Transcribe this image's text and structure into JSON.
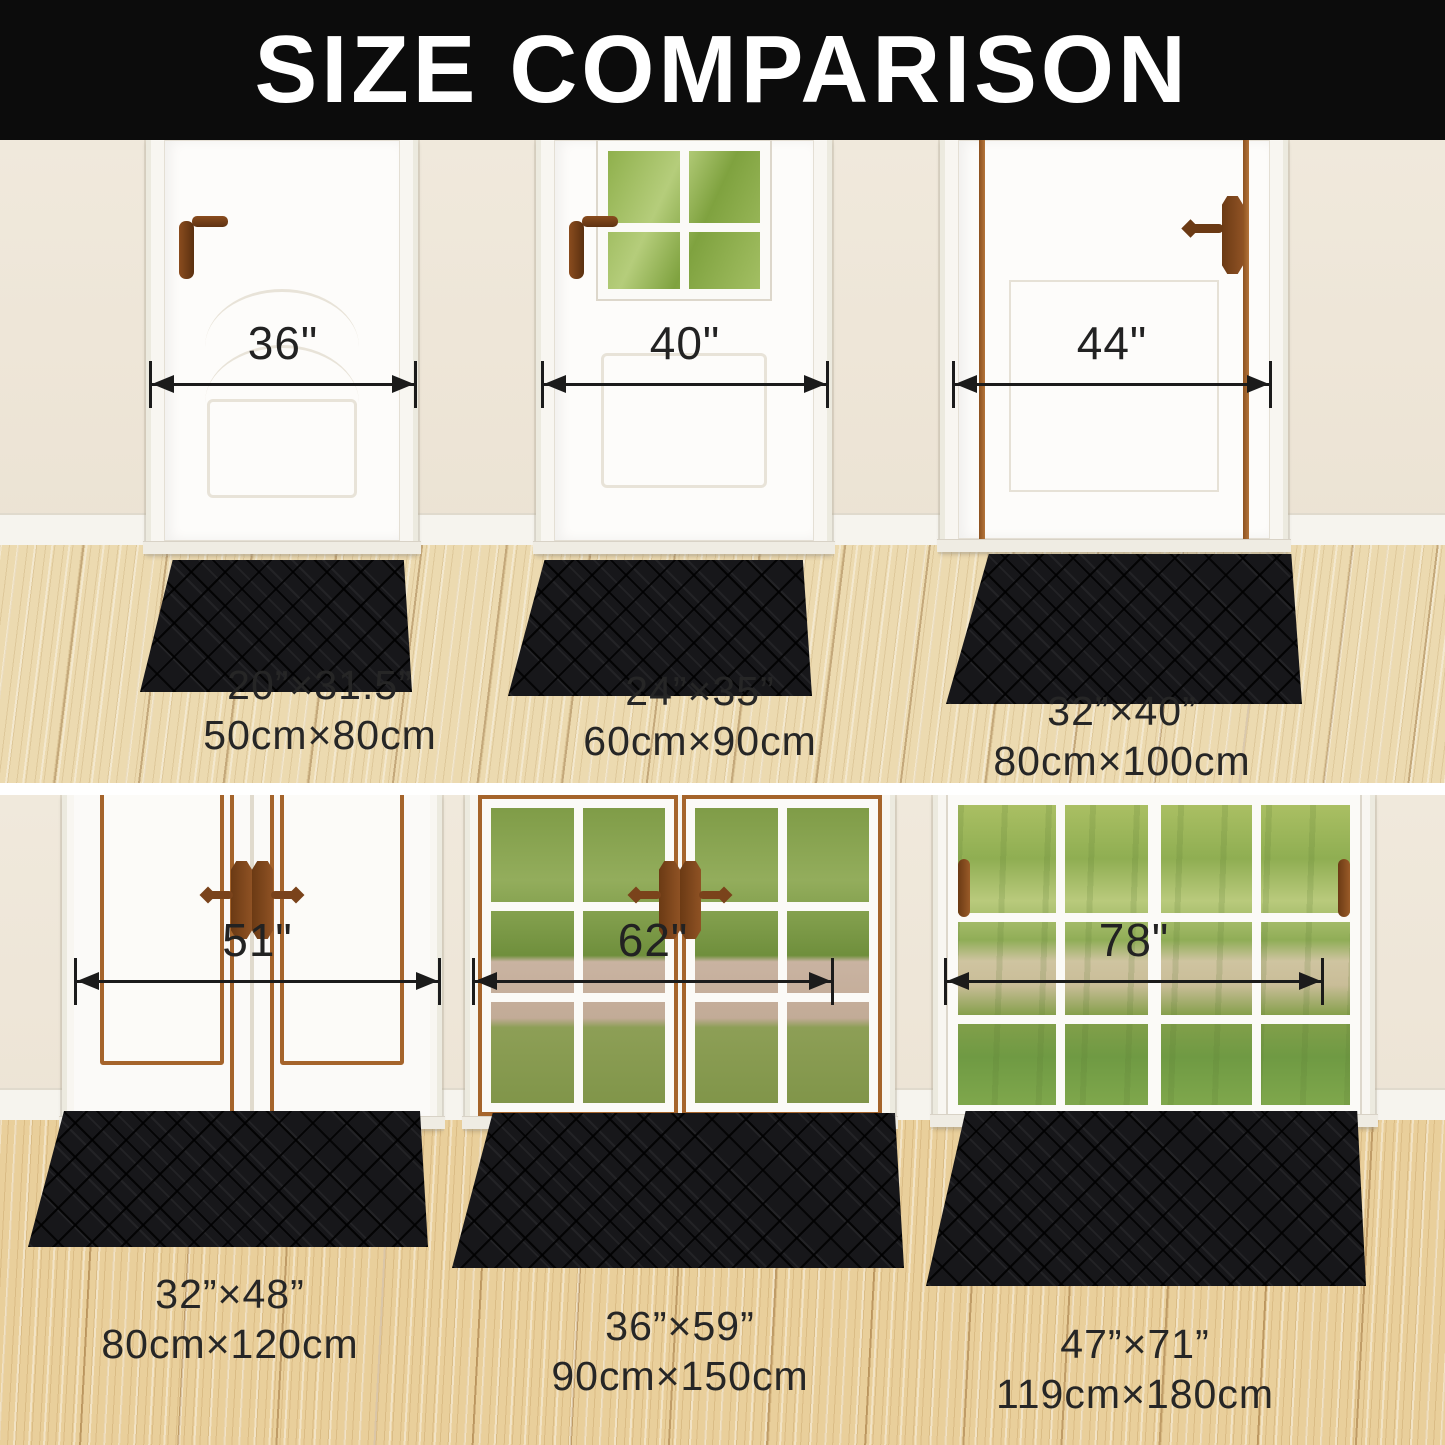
{
  "title": "SIZE COMPARISON",
  "top_row": {
    "items": [
      {
        "door_width": "36\"",
        "size_in": "20”×31.5”",
        "size_cm": "50cm×80cm"
      },
      {
        "door_width": "40\"",
        "size_in": "24”×35”",
        "size_cm": "60cm×90cm"
      },
      {
        "door_width": "44\"",
        "size_in": "32”×40”",
        "size_cm": "80cm×100cm"
      }
    ]
  },
  "bottom_row": {
    "items": [
      {
        "door_width": "51\"",
        "size_in": "32”×48”",
        "size_cm": "80cm×120cm"
      },
      {
        "door_width": "62\"",
        "size_in": "36”×59”",
        "size_cm": "90cm×150cm"
      },
      {
        "door_width": "78\"",
        "size_in": "47”×71”",
        "size_cm": "119cm×180cm"
      }
    ]
  },
  "colors": {
    "banner": "#0c0c0c",
    "door_trim": "#a5642b",
    "mat": "#17171a",
    "wall": "#ede5d7",
    "floor_top": "#ecdab0",
    "floor_bottom": "#e9cf9b"
  }
}
